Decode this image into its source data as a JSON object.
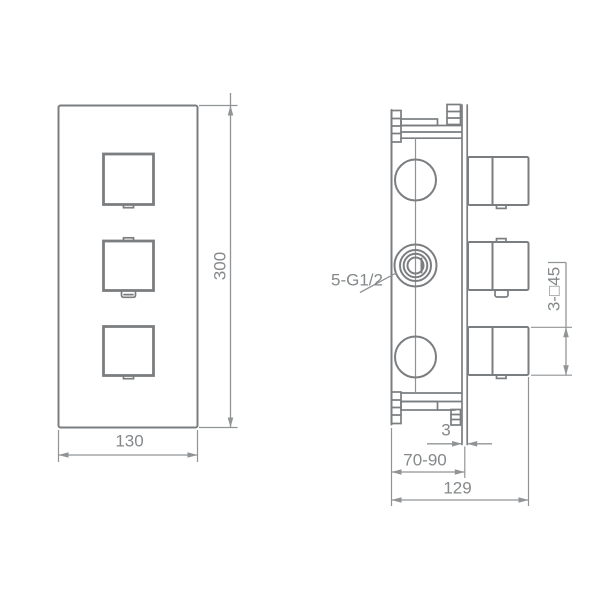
{
  "drawing": {
    "type": "technical-dimension-drawing",
    "colors": {
      "line": "#7b7e80",
      "dim": "#919496",
      "text": "#85888a",
      "bg": "#ffffff"
    },
    "front_view": {
      "width_label": "130",
      "height_label": "300"
    },
    "side_view": {
      "ports_label": "5-G1/2",
      "handles_label": "3-□45",
      "plate_thickness_label": "3",
      "install_depth_label": "70-90",
      "total_depth_label": "129"
    }
  }
}
